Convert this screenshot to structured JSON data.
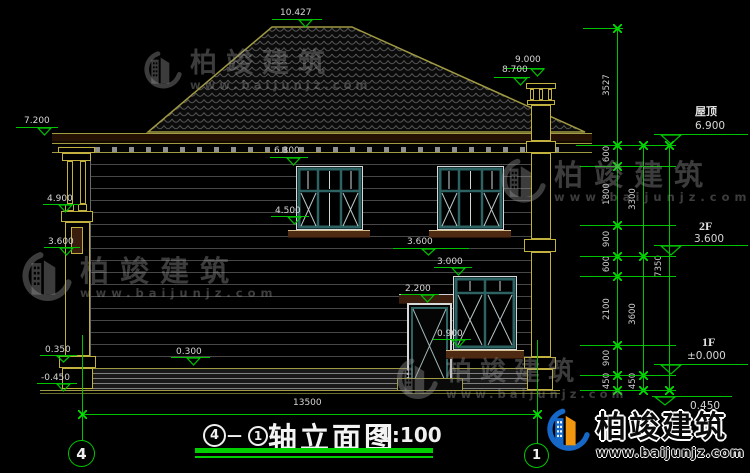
{
  "watermark": {
    "brand": "柏竣建筑",
    "url": "www.baijunjz.com"
  },
  "title": {
    "bubble_left": "4",
    "dash": "—",
    "bubble_right": "1",
    "name": "轴立面图",
    "scale": "1:100"
  },
  "axis": {
    "left": "4",
    "right": "1",
    "span": "13500"
  },
  "floors": {
    "roof": "屋顶",
    "roof_val": "6.900",
    "f2": "2F",
    "f2_val": "3.600",
    "f1": "1F",
    "f1_val": "±0.000",
    "basement_val": "0.450"
  },
  "colors": {
    "dimension_green": "#00c300",
    "tick_green": "#00e000",
    "structure_yellow": "#c2b13e",
    "roof_outline": "#a09a42",
    "window_teal": "#2e6363",
    "frame_white": "#d9d9d9",
    "fascia_brown": "#241104",
    "sill_brown": "#4f2a12",
    "dim_text": "#d6d6d6",
    "logo_blue": "#1668c8",
    "logo_orange": "#f0960f"
  },
  "annotations": {
    "dim_markers": [
      {
        "label": "10.427",
        "tx": 280,
        "ty": 8,
        "lx": 272,
        "ly": 19,
        "lw": 50,
        "ax": 305,
        "level": 28
      },
      {
        "label": "9.000",
        "tx": 515,
        "ty": 55,
        "lx": 506,
        "ly": 68,
        "lw": 38,
        "ax": 537,
        "level": 77
      },
      {
        "label": "8.700",
        "tx": 502,
        "ty": 65,
        "lx": 494,
        "ly": 77,
        "lw": 36,
        "ax": 520,
        "level": 86
      },
      {
        "label": "7.200",
        "tx": 24,
        "ty": 116,
        "lx": 16,
        "ly": 127,
        "lw": 42,
        "ax": 44,
        "level": 136
      },
      {
        "label": "6.300",
        "tx": 274,
        "ty": 146,
        "lx": 270,
        "ly": 157,
        "lw": 38,
        "ax": 293,
        "level": 166
      },
      {
        "label": "4.900",
        "tx": 47,
        "ty": 194,
        "lx": 43,
        "ly": 204,
        "lw": 36,
        "ax": 65,
        "level": 213
      },
      {
        "label": "4.500",
        "tx": 275,
        "ty": 206,
        "lx": 271,
        "ly": 216,
        "lw": 38,
        "ax": 294,
        "level": 225
      },
      {
        "label": "3.600",
        "tx": 48,
        "ty": 237,
        "lx": 44,
        "ly": 247,
        "lw": 36,
        "ax": 66,
        "level": 256
      },
      {
        "label": "3.600",
        "tx": 407,
        "ty": 237,
        "lx": 393,
        "ly": 248,
        "lw": 76,
        "ax": 428,
        "level": 256
      },
      {
        "label": "3.000",
        "tx": 437,
        "ty": 257,
        "lx": 434,
        "ly": 267,
        "lw": 38,
        "ax": 458,
        "level": 276
      },
      {
        "label": "2.200",
        "tx": 405,
        "ty": 284,
        "lx": 401,
        "ly": 294,
        "lw": 38,
        "ax": 427,
        "level": 303
      },
      {
        "label": "0.900",
        "tx": 437,
        "ty": 329,
        "lx": 433,
        "ly": 339,
        "lw": 38,
        "ax": 458,
        "level": 348
      },
      {
        "label": "0.350",
        "tx": 45,
        "ty": 345,
        "lx": 40,
        "ly": 355,
        "lw": 37,
        "ax": 63,
        "level": 363
      },
      {
        "label": "0.300",
        "tx": 176,
        "ty": 347,
        "lx": 171,
        "ly": 357,
        "lw": 39,
        "ax": 193,
        "level": 366
      },
      {
        "label": "-0.450",
        "tx": 41,
        "ty": 373,
        "lx": 37,
        "ly": 383,
        "lw": 40,
        "ax": 63,
        "level": 392
      },
      {
        "label": "",
        "big": true,
        "lx": 654,
        "ly": 134,
        "lw": 94,
        "ax": 671,
        "level": 145
      },
      {
        "label": "",
        "big": true,
        "lx": 654,
        "ly": 245,
        "lw": 94,
        "ax": 671,
        "level": 256
      },
      {
        "label": "",
        "big": true,
        "lx": 654,
        "ly": 364,
        "lw": 94,
        "ax": 671,
        "level": 375
      },
      {
        "label": "",
        "big": true,
        "lx": 652,
        "ly": 396,
        "lw": 80,
        "ax": 665,
        "level": 406
      }
    ],
    "chains": [
      {
        "x": 617,
        "joints": [
          28,
          145,
          166,
          225,
          256,
          276,
          345,
          375,
          390
        ],
        "labels": [
          "3527",
          "600",
          "1800",
          "900",
          "600",
          "2100",
          "900",
          "450"
        ]
      },
      {
        "x": 643,
        "joints": [
          145,
          256,
          375,
          390
        ],
        "labels": [
          "3300",
          "3600",
          "450"
        ]
      },
      {
        "x": 669,
        "joints": [
          145,
          390
        ],
        "labels": [
          "7350"
        ]
      }
    ],
    "ext_lines": [
      {
        "x": 583,
        "y": 28,
        "w": 40
      },
      {
        "x": 576,
        "y": 145,
        "w": 100
      },
      {
        "x": 580,
        "y": 166,
        "w": 96
      },
      {
        "x": 580,
        "y": 225,
        "w": 96
      },
      {
        "x": 580,
        "y": 256,
        "w": 96
      },
      {
        "x": 580,
        "y": 276,
        "w": 96
      },
      {
        "x": 580,
        "y": 345,
        "w": 96
      },
      {
        "x": 580,
        "y": 375,
        "w": 96
      },
      {
        "x": 580,
        "y": 390,
        "w": 96
      }
    ]
  }
}
